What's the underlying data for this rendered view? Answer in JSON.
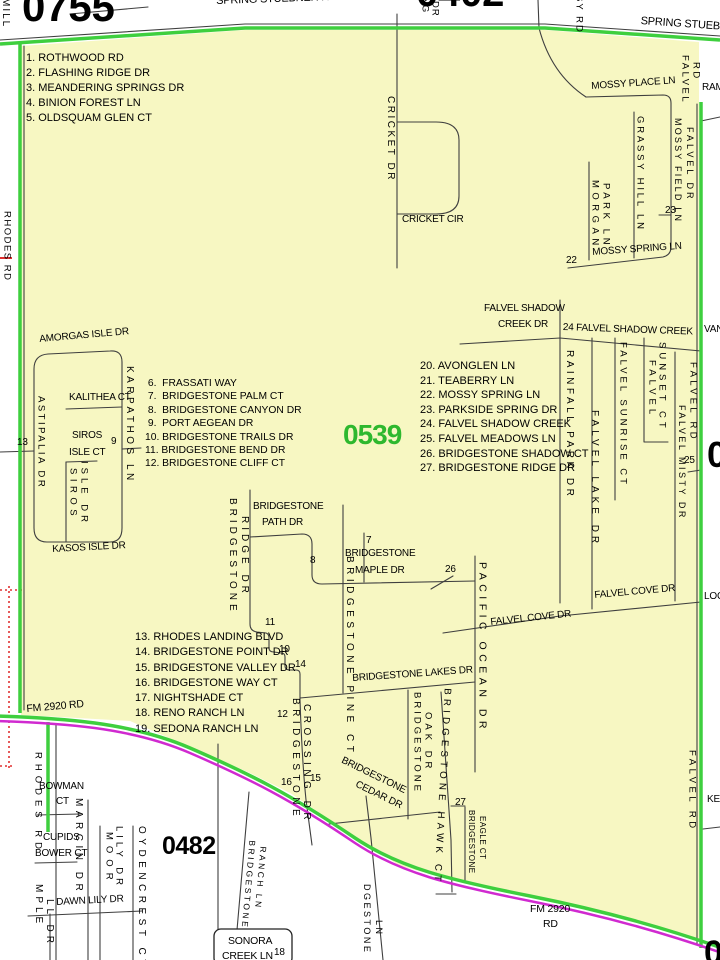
{
  "district": {
    "current_number": "0539",
    "adjacent_numbers": [
      "0755",
      "0402",
      "0482"
    ],
    "edge_number_fragments": [
      "05",
      "0"
    ]
  },
  "colors": {
    "district_fill": "#f7f7c2",
    "boundary_green": "#3ecf3e",
    "boundary_magenta": "#d02ad0",
    "road_line": "#3f3f3f",
    "grid_red": "#e03030",
    "district_number_green": "#2eb82e",
    "text_black": "#000000"
  },
  "index_lists": [
    {
      "id": "nw",
      "x": 26,
      "y": 51,
      "lh": 15,
      "fs": 11,
      "items": [
        "1. ROTHWOOD RD",
        "2. FLASHING RIDGE DR",
        "3. MEANDERING SPRINGS DR",
        "4. BINION FOREST LN",
        "5. OLDSQUAM GLEN CT"
      ]
    },
    {
      "id": "center",
      "x": 145,
      "y": 377,
      "lh": 13.4,
      "fs": 10.3,
      "items": [
        " 6.  FRASSATI WAY",
        " 7.  BRIDGESTONE PALM CT",
        " 8.  BRIDGESTONE CANYON DR",
        " 9.  PORT AEGEAN DR",
        "10. BRIDGESTONE TRAILS DR",
        "11. BRIDGESTONE BEND DR",
        "12. BRIDGESTONE CLIFF CT"
      ]
    },
    {
      "id": "sw",
      "x": 135,
      "y": 630,
      "lh": 15.3,
      "fs": 11,
      "items": [
        "13. RHODES LANDING BLVD",
        "14. BRIDGESTONE POINT DR",
        "15. BRIDGESTONE VALLEY DR",
        "16. BRIDGESTONE WAY CT",
        "17. NIGHTSHADE CT",
        "18. RENO RANCH LN",
        "19. SEDONA RANCH LN"
      ]
    },
    {
      "id": "east",
      "x": 420,
      "y": 359,
      "lh": 14.6,
      "fs": 11,
      "items": [
        "20. AVONGLEN LN",
        "21. TEABERRY LN",
        "22. MOSSY SPRING LN",
        "23. PARKSIDE SPRING DR",
        "24. FALVEL SHADOW CREEK",
        "25. FALVEL MEADOWS LN",
        "26. BRIDGESTONE SHADOW CT",
        "27. BRIDGESTONE RIDGE DR"
      ]
    }
  ],
  "map_labels": [
    {
      "id": "num-0755",
      "t": "0755",
      "x": 22,
      "y": -14,
      "s": 42,
      "w": 1
    },
    {
      "id": "num-0402",
      "t": "0402",
      "x": 416,
      "y": -27,
      "s": 40,
      "w": 1
    },
    {
      "id": "num-0539",
      "t": "0539",
      "x": 343,
      "y": 421,
      "s": 28,
      "w": 1,
      "c": "#2eb82e",
      "ls": "-1"
    },
    {
      "id": "num-0482",
      "t": "0482",
      "x": 162,
      "y": 834,
      "s": 25,
      "w": 1,
      "ls": "-0.5"
    },
    {
      "id": "num-right-mid",
      "t": "05",
      "x": 707,
      "y": 437,
      "s": 36,
      "w": 1
    },
    {
      "id": "num-bottom-right",
      "t": "0",
      "x": 704,
      "y": 936,
      "s": 34,
      "w": 1
    },
    {
      "id": "spring-stuebner-rd-top",
      "t": "SPRING STUEBNER RD",
      "x": 216,
      "y": -4,
      "s": 11,
      "r": -2
    },
    {
      "id": "spring-stuebner-rd-right",
      "t": "SPRING STUEBNER RD",
      "x": 641,
      "y": 16,
      "s": 11,
      "r": 4
    },
    {
      "id": "mill-fragment",
      "t": "MILL",
      "x": 0,
      "y": -2,
      "o": "v",
      "s": 10,
      "ls": "2"
    },
    {
      "id": "ng-fragment",
      "t": "NG",
      "x": 420,
      "y": -3,
      "o": "v",
      "s": 9.5
    },
    {
      "id": "dr-fragment",
      "t": "DR",
      "x": 430,
      "y": 1,
      "o": "v",
      "s": 9.5
    },
    {
      "id": "sy-rd-fragment",
      "t": "SY RD",
      "x": 574,
      "y": -5,
      "o": "v",
      "s": 9.5,
      "ls": "2"
    },
    {
      "id": "rhodes-rd-north",
      "t": "RHODES RD",
      "x": 2,
      "y": 211,
      "o": "v",
      "s": 9.5,
      "ls": "1.5"
    },
    {
      "id": "ram-fragment",
      "t": "RAM",
      "x": 702,
      "y": 83,
      "s": 10
    },
    {
      "id": "cricket-dr",
      "t": "CRICKET DR",
      "x": 385,
      "y": 96,
      "o": "v",
      "s": 10,
      "ls": "2.5"
    },
    {
      "id": "cricket-cir",
      "t": "CRICKET CIR",
      "x": 402,
      "y": 215,
      "s": 10
    },
    {
      "id": "mossy-place-ln",
      "t": "MOSSY PLACE LN",
      "x": 591,
      "y": 82,
      "s": 10,
      "r": -4
    },
    {
      "id": "falvel-rd-ne-1",
      "t": "FALVEL",
      "x": 680,
      "y": 55,
      "o": "v",
      "s": 9.5,
      "ls": "2.5"
    },
    {
      "id": "falvel-rd-ne-2",
      "t": "RD",
      "x": 691,
      "y": 62,
      "o": "v",
      "s": 9.5,
      "ls": "2.5"
    },
    {
      "id": "mossy-field-ln",
      "t": "MOSSY FIELD LN",
      "x": 673,
      "y": 118,
      "o": "v",
      "s": 9,
      "ls": "2.2"
    },
    {
      "id": "falvel-dr",
      "t": "FALVEL DR",
      "x": 685,
      "y": 127,
      "o": "v",
      "s": 9,
      "ls": "3"
    },
    {
      "id": "grassy-hill-ln",
      "t": "GRASSY HILL LN",
      "x": 635,
      "y": 116,
      "o": "v",
      "s": 9.5,
      "ls": "2.8"
    },
    {
      "id": "morgan-park-ln-1",
      "t": "MORGAN",
      "x": 590,
      "y": 180,
      "o": "v",
      "s": 9.5,
      "ls": "4.5"
    },
    {
      "id": "morgan-park-ln-2",
      "t": "PARK LN",
      "x": 601,
      "y": 183,
      "o": "v",
      "s": 9.5,
      "ls": "3.6"
    },
    {
      "id": "map-num-23",
      "t": "23",
      "x": 665,
      "y": 206,
      "s": 10
    },
    {
      "id": "mossy-spring-ln",
      "t": "MOSSY SPRING LN",
      "x": 592,
      "y": 248,
      "s": 10,
      "r": -4
    },
    {
      "id": "map-num-22",
      "t": "22",
      "x": 566,
      "y": 256,
      "s": 10
    },
    {
      "id": "amorgas-isle-dr",
      "t": "AMORGAS ISLE DR",
      "x": 39,
      "y": 335,
      "s": 10,
      "r": -5
    },
    {
      "id": "astipalia-dr",
      "t": "ASTIPALIA DR",
      "x": 36,
      "y": 396,
      "o": "v",
      "s": 9.5,
      "ls": "2.5"
    },
    {
      "id": "kalithea-ct",
      "t": "KALITHEA CT",
      "x": 69,
      "y": 393,
      "s": 10
    },
    {
      "id": "karpathos-ln",
      "t": "KARPATHOS LN",
      "x": 124,
      "y": 366,
      "o": "v",
      "s": 10,
      "ls": "3.5"
    },
    {
      "id": "map-num-13",
      "t": "13",
      "x": 17,
      "y": 438,
      "s": 10
    },
    {
      "id": "map-num-9",
      "t": "9",
      "x": 111,
      "y": 437,
      "s": 10
    },
    {
      "id": "siros-isle-ct-1",
      "t": "SIROS",
      "x": 72,
      "y": 431,
      "s": 10
    },
    {
      "id": "siros-isle-ct-2",
      "t": "ISLE CT",
      "x": 69,
      "y": 448,
      "s": 10
    },
    {
      "id": "siros-isle-dr-1",
      "t": "SIROS",
      "x": 68,
      "y": 468,
      "o": "v",
      "s": 9.5,
      "ls": "4.5"
    },
    {
      "id": "siros-isle-dr-2",
      "t": "ISLE DR",
      "x": 79,
      "y": 461,
      "o": "v",
      "s": 9.5,
      "ls": "4"
    },
    {
      "id": "kasos-isle-dr",
      "t": "KASOS ISLE DR",
      "x": 52,
      "y": 545,
      "s": 10,
      "r": -3
    },
    {
      "id": "falvel-shadow-creek-dr-1",
      "t": "FALVEL SHADOW",
      "x": 484,
      "y": 304,
      "s": 10
    },
    {
      "id": "falvel-shadow-creek-dr-2",
      "t": "CREEK DR",
      "x": 498,
      "y": 320,
      "s": 10
    },
    {
      "id": "falvel-shadow-creek-24",
      "t": "24 FALVEL SHADOW CREEK",
      "x": 563,
      "y": 323,
      "s": 10,
      "r": 2
    },
    {
      "id": "van-fragment",
      "t": "VAN",
      "x": 704,
      "y": 325,
      "s": 10
    },
    {
      "id": "rainfall-park-dr",
      "t": "RAINFALL PARK DR",
      "x": 564,
      "y": 350,
      "o": "v",
      "s": 10,
      "ls": "3.5"
    },
    {
      "id": "falvel-lake-dr",
      "t": "FALVEL LAKE DR",
      "x": 589,
      "y": 410,
      "o": "v",
      "s": 10,
      "ls": "4"
    },
    {
      "id": "falvel-sunrise-ct",
      "t": "FALVEL SUNRISE CT",
      "x": 618,
      "y": 342,
      "o": "v",
      "s": 9.5,
      "ls": "3"
    },
    {
      "id": "falvel-sunset-ct-1",
      "t": "FALVEL",
      "x": 647,
      "y": 360,
      "o": "v",
      "s": 9.5,
      "ls": "4"
    },
    {
      "id": "falvel-sunset-ct-2",
      "t": "SUNSET CT",
      "x": 657,
      "y": 342,
      "o": "v",
      "s": 9.5,
      "ls": "4"
    },
    {
      "id": "falvel-misty-dr",
      "t": "FALVEL MISTY DR",
      "x": 677,
      "y": 405,
      "o": "v",
      "s": 9,
      "ls": "2.5"
    },
    {
      "id": "falvel-rd-mid",
      "t": "FALVEL RD",
      "x": 688,
      "y": 362,
      "o": "v",
      "s": 9.5,
      "ls": "3.3"
    },
    {
      "id": "map-num-25",
      "t": "25",
      "x": 684,
      "y": 456,
      "s": 10
    },
    {
      "id": "falvel-cove-dr-w",
      "t": "FALVEL COVE DR",
      "x": 490,
      "y": 618,
      "s": 10,
      "r": -6
    },
    {
      "id": "falvel-cove-dr-e",
      "t": "FALVEL COVE DR",
      "x": 594,
      "y": 591,
      "s": 10,
      "r": -5
    },
    {
      "id": "loc-fragment",
      "t": "LOC",
      "x": 704,
      "y": 592,
      "s": 10
    },
    {
      "id": "map-num-26",
      "t": "26",
      "x": 445,
      "y": 565,
      "s": 10
    },
    {
      "id": "bridgestone-ridge-dr-1",
      "t": "BRIDGESTONE",
      "x": 227,
      "y": 498,
      "o": "v",
      "s": 10,
      "ls": "4"
    },
    {
      "id": "bridgestone-ridge-dr-2",
      "t": "RIDGE DR",
      "x": 239,
      "y": 516,
      "o": "v",
      "s": 10,
      "ls": "4"
    },
    {
      "id": "bridgestone-path-dr-1",
      "t": "BRIDGESTONE",
      "x": 253,
      "y": 502,
      "s": 10
    },
    {
      "id": "bridgestone-path-dr-2",
      "t": "PATH DR",
      "x": 262,
      "y": 518,
      "s": 10
    },
    {
      "id": "map-num-8",
      "t": "8",
      "x": 310,
      "y": 556,
      "s": 10
    },
    {
      "id": "map-num-7",
      "t": "7",
      "x": 366,
      "y": 536,
      "s": 10
    },
    {
      "id": "bridgestone-maple-dr-1",
      "t": "BRIDGESTONE",
      "x": 345,
      "y": 549,
      "s": 10
    },
    {
      "id": "bridgestone-maple-dr-2",
      "t": "MAPLE DR",
      "x": 355,
      "y": 566,
      "s": 10
    },
    {
      "id": "bridgestone-pine-ct",
      "t": "BRIDGESTONE PINE CT",
      "x": 344,
      "y": 556,
      "o": "v",
      "s": 10,
      "ls": "4.5"
    },
    {
      "id": "pacific-ocean-dr",
      "t": "PACIFIC OCEAN DR",
      "x": 477,
      "y": 562,
      "o": "v",
      "s": 10.5,
      "ls": "4.5"
    },
    {
      "id": "map-num-11",
      "t": "11",
      "x": 265,
      "y": 618,
      "s": 10
    },
    {
      "id": "map-num-10",
      "t": "10",
      "x": 279,
      "y": 645,
      "s": 10
    },
    {
      "id": "map-num-14",
      "t": "14",
      "x": 295,
      "y": 660,
      "s": 10
    },
    {
      "id": "bridgestone-lakes-dr",
      "t": "BRIDGESTONE LAKES DR",
      "x": 352,
      "y": 674,
      "s": 10,
      "r": -4
    },
    {
      "id": "map-num-12",
      "t": "12",
      "x": 277,
      "y": 710,
      "s": 10
    },
    {
      "id": "bridgestone-crossing-dr-1",
      "t": "BRIDGESTONE",
      "x": 290,
      "y": 698,
      "o": "v",
      "s": 10,
      "ls": "4.5"
    },
    {
      "id": "bridgestone-crossing-dr-2",
      "t": "CROSSING DR",
      "x": 301,
      "y": 704,
      "o": "v",
      "s": 10,
      "ls": "4.5"
    },
    {
      "id": "map-num-16",
      "t": "16",
      "x": 281,
      "y": 778,
      "s": 10
    },
    {
      "id": "map-num-15",
      "t": "15",
      "x": 310,
      "y": 774,
      "s": 10
    },
    {
      "id": "bridgestone-oak-dr-1",
      "t": "BRIDGESTONE",
      "x": 412,
      "y": 692,
      "o": "v",
      "s": 9.5,
      "ls": "3"
    },
    {
      "id": "bridgestone-oak-dr-2",
      "t": "OAK DR",
      "x": 423,
      "y": 712,
      "o": "v",
      "s": 9.5,
      "ls": "4"
    },
    {
      "id": "bridgestone-cedar-dr-1",
      "t": "BRIDGESTONE",
      "x": 344,
      "y": 756,
      "s": 10,
      "r": 26
    },
    {
      "id": "bridgestone-cedar-dr-2",
      "t": "CEDAR DR",
      "x": 358,
      "y": 780,
      "s": 10,
      "r": 26
    },
    {
      "id": "bridgestone-hawk-ct",
      "t": "BRIDGESTONE HAWK CT",
      "x": 442,
      "y": 688,
      "o": "v",
      "s": 9.7,
      "ls": "4.2",
      "r": 3
    },
    {
      "id": "map-num-27",
      "t": "27",
      "x": 455,
      "y": 798,
      "s": 10
    },
    {
      "id": "bridgestone-eagle-ct-1",
      "t": "BRIDGESTONE",
      "x": 467,
      "y": 810,
      "o": "v",
      "s": 8,
      "ls": "0.5"
    },
    {
      "id": "bridgestone-eagle-ct-2",
      "t": "EAGLE CT",
      "x": 478,
      "y": 816,
      "o": "v",
      "s": 8,
      "ls": "0.5"
    },
    {
      "id": "ke-fragment",
      "t": "KE",
      "x": 707,
      "y": 795,
      "s": 10
    },
    {
      "id": "falvel-rd-south",
      "t": "FALVEL RD",
      "x": 687,
      "y": 750,
      "o": "v",
      "s": 9.5,
      "ls": "3.5"
    },
    {
      "id": "fm-2920-rd-west",
      "t": "FM 2920 RD",
      "x": 26,
      "y": 704,
      "s": 10.5,
      "r": -5
    },
    {
      "id": "rhodes-rd-south",
      "t": "RHODES RD",
      "x": 33,
      "y": 752,
      "o": "v",
      "s": 9.5,
      "ls": "5"
    },
    {
      "id": "bowman-ct-1",
      "t": "BOWMAN",
      "x": 39,
      "y": 782,
      "s": 10
    },
    {
      "id": "bowman-ct-2",
      "t": "CT",
      "x": 56,
      "y": 797,
      "s": 10
    },
    {
      "id": "cupids-bower-ct-1",
      "t": "CUPIDS",
      "x": 43,
      "y": 833,
      "s": 10
    },
    {
      "id": "cupids-bower-ct-2",
      "t": "BOWER CT",
      "x": 35,
      "y": 849,
      "s": 10
    },
    {
      "id": "marcin-dr",
      "t": "MARCIN DR",
      "x": 73,
      "y": 798,
      "o": "v",
      "s": 10,
      "ls": "4.5"
    },
    {
      "id": "moor-lily-dr-1",
      "t": "MOOR",
      "x": 104,
      "y": 832,
      "o": "v",
      "s": 9.5,
      "ls": "6"
    },
    {
      "id": "moor-lily-dr-2",
      "t": "LILY DR",
      "x": 114,
      "y": 826,
      "o": "v",
      "s": 9.5,
      "ls": "4"
    },
    {
      "id": "oydencrest-ct",
      "t": "OYDENCREST CT",
      "x": 136,
      "y": 826,
      "o": "v",
      "s": 10,
      "ls": "4.5"
    },
    {
      "id": "dawn-lily-dr",
      "t": "DAWN LILY DR",
      "x": 56,
      "y": 898,
      "s": 10,
      "r": -3
    },
    {
      "id": "mple-fragment",
      "t": "MPLE",
      "x": 33,
      "y": 884,
      "o": "v",
      "s": 10,
      "ls": "4"
    },
    {
      "id": "ll-dr-fragment",
      "t": "LL DR",
      "x": 44,
      "y": 899,
      "o": "v",
      "s": 10,
      "ls": "4"
    },
    {
      "id": "bridgestone-ranch-ln-1",
      "t": "BRIDGESTONE",
      "x": 248,
      "y": 840,
      "o": "v",
      "s": 8.5,
      "ls": "2.5",
      "r": 5
    },
    {
      "id": "bridgestone-ranch-ln-2",
      "t": "RANCH LN",
      "x": 259,
      "y": 846,
      "o": "v",
      "s": 8.5,
      "ls": "2.5",
      "r": 5
    },
    {
      "id": "sonora-creek-ln-1",
      "t": "SONORA",
      "x": 228,
      "y": 936,
      "s": 10.5
    },
    {
      "id": "sonora-creek-ln-2",
      "t": "CREEK LN",
      "x": 222,
      "y": 951,
      "s": 10.5
    },
    {
      "id": "map-num-18",
      "t": "18",
      "x": 274,
      "y": 948,
      "s": 10
    },
    {
      "id": "dgestone-fragment",
      "t": "DGESTONE",
      "x": 362,
      "y": 884,
      "o": "v",
      "s": 9,
      "ls": "2.5"
    },
    {
      "id": "ln-fragment",
      "t": "LN",
      "x": 374,
      "y": 920,
      "o": "v",
      "s": 9,
      "ls": "2.5"
    },
    {
      "id": "fm-2920-rd-south-1",
      "t": "FM 2920",
      "x": 530,
      "y": 904,
      "s": 10.5
    },
    {
      "id": "fm-2920-rd-south-2",
      "t": "RD",
      "x": 543,
      "y": 919,
      "s": 10.5
    }
  ]
}
